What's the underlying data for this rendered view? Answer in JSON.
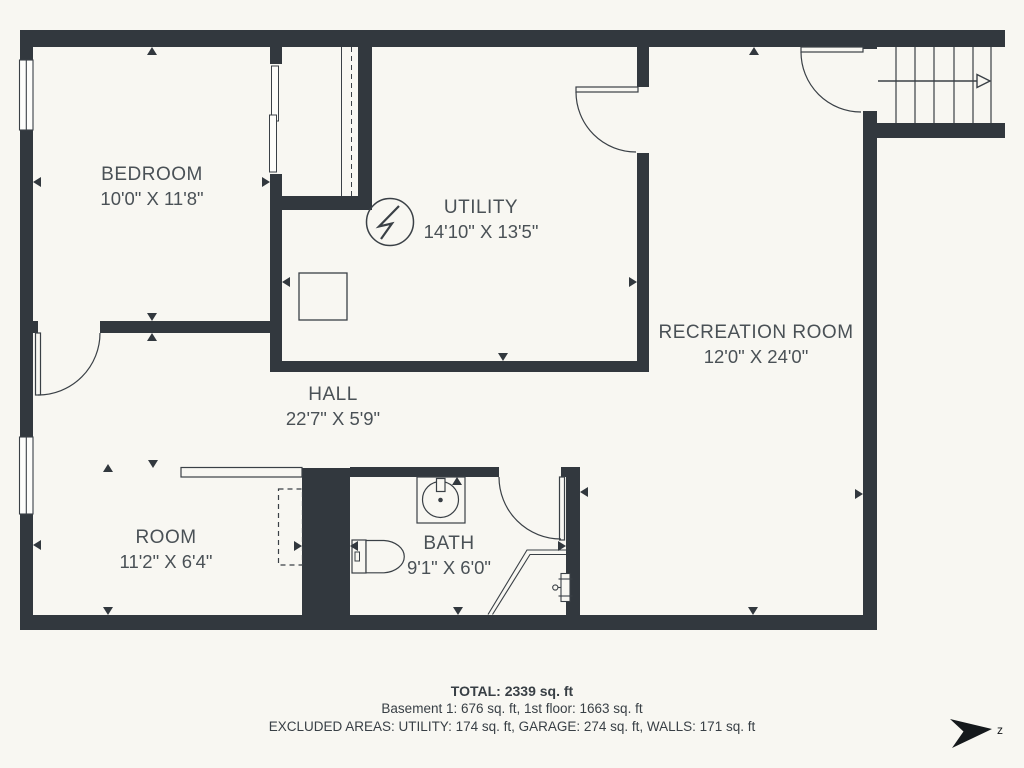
{
  "colors": {
    "background": "#F8F7F2",
    "wall": "#32383E",
    "line": "#3A4046",
    "label_text": "#4A5156",
    "footer_text": "#383F45",
    "compass": "#15191C"
  },
  "rooms": {
    "bedroom": {
      "name": "BEDROOM",
      "dims": "10'0\" X 11'8\""
    },
    "utility": {
      "name": "UTILITY",
      "dims": "14'10\" X 13'5\""
    },
    "recreation": {
      "name": "RECREATION ROOM",
      "dims": "12'0\" X 24'0\""
    },
    "hall": {
      "name": "HALL",
      "dims": "22'7\" X 5'9\""
    },
    "room": {
      "name": "ROOM",
      "dims": "11'2\" X 6'4\""
    },
    "bath": {
      "name": "BATH",
      "dims": "9'1\" X 6'0\""
    }
  },
  "footer": {
    "total": "TOTAL: 2339 sq. ft",
    "floors": "Basement 1: 676 sq. ft, 1st floor: 1663 sq. ft",
    "excluded": "EXCLUDED AREAS: UTILITY: 174 sq. ft, GARAGE: 274 sq. ft, WALLS: 171 sq. ft"
  },
  "compass": {
    "label": "z"
  },
  "icons": {
    "stairs": "stairs-with-up-arrow",
    "electrical_panel": "circle-lightning-bolt",
    "water_heater": "square-outline",
    "sink": "basin-with-faucet",
    "toilet": "tank-and-bowl",
    "shower": "corner-glass-shower",
    "window": "double-line-window",
    "door": "quarter-arc-swing-door",
    "sliding_door": "bypass-sliding-door",
    "compass": "north-arrow"
  }
}
